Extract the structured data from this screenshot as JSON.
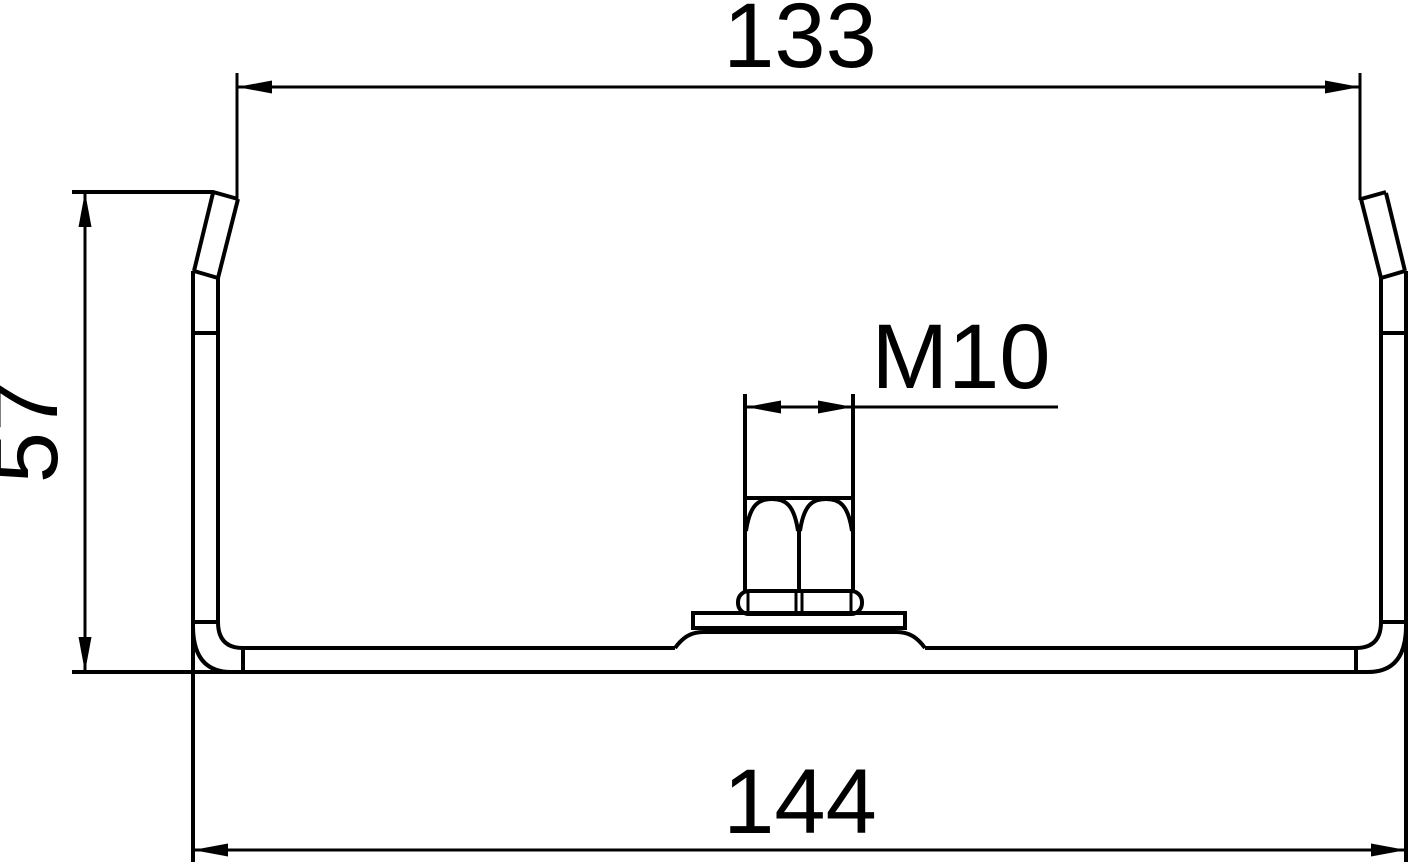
{
  "dimensions": {
    "top_width": {
      "label": "133"
    },
    "height": {
      "label": "57"
    },
    "bottom_width": {
      "label": "144"
    },
    "thread": {
      "label": "M10"
    }
  },
  "colors": {
    "ink": "#000000",
    "background": "#ffffff"
  }
}
